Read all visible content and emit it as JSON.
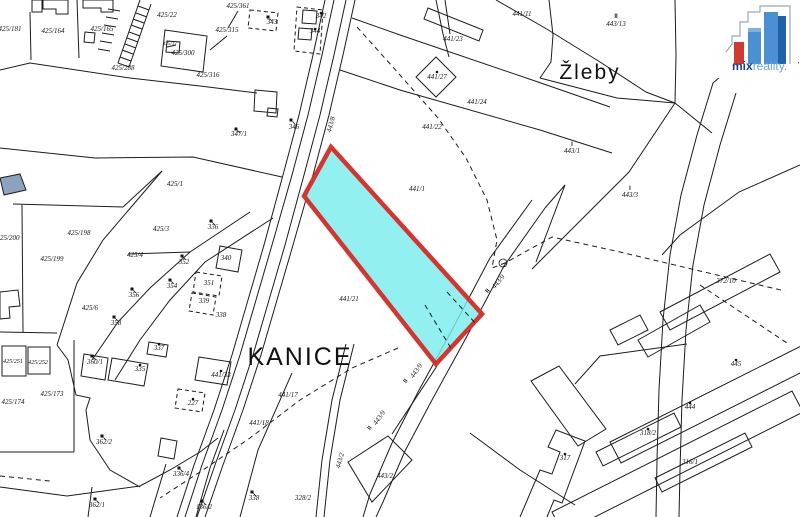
{
  "map": {
    "background": "#ffffff",
    "line_color": "#1c1c1c",
    "highlight": {
      "parcel_points": "331,147 304,196 436,364 482,314",
      "fill": "#7BEDEE",
      "fill_opacity": 0.82,
      "stroke": "#d4362f",
      "stroke_width": 4.5
    },
    "place_labels": [
      {
        "t": "KANICE",
        "x": 300,
        "y": 365,
        "s": 25
      },
      {
        "t": "Žleby",
        "x": 590,
        "y": 79,
        "s": 21
      }
    ],
    "parcel_labels": [
      {
        "t": "425/181",
        "x": 10,
        "y": 31
      },
      {
        "t": "425/164",
        "x": 53,
        "y": 33
      },
      {
        "t": "425/165",
        "x": 102,
        "y": 31
      },
      {
        "t": "425/22",
        "x": 167,
        "y": 17
      },
      {
        "t": "425/315",
        "x": 227,
        "y": 32
      },
      {
        "t": "425/361",
        "x": 238,
        "y": 8
      },
      {
        "t": "425/300",
        "x": 183,
        "y": 55
      },
      {
        "t": "425/17",
        "x": 170,
        "y": 45,
        "s": 5
      },
      {
        "t": "425/316",
        "x": 208,
        "y": 77
      },
      {
        "t": "425/288",
        "x": 123,
        "y": 70
      },
      {
        "t": "347/1",
        "x": 239,
        "y": 136
      },
      {
        "t": "343",
        "x": 272,
        "y": 24
      },
      {
        "t": "342",
        "x": 321,
        "y": 18
      },
      {
        "t": "344",
        "x": 315,
        "y": 33
      },
      {
        "t": "346",
        "x": 294,
        "y": 129
      },
      {
        "t": "441/23",
        "x": 453,
        "y": 41
      },
      {
        "t": "441/27",
        "x": 437,
        "y": 79
      },
      {
        "t": "441/24",
        "x": 477,
        "y": 104
      },
      {
        "t": "441/22",
        "x": 432,
        "y": 129
      },
      {
        "t": "441/11",
        "x": 522,
        "y": 16
      },
      {
        "t": "443/13",
        "x": 616,
        "y": 26
      },
      {
        "t": "443/1",
        "x": 572,
        "y": 153
      },
      {
        "t": "443/3",
        "x": 630,
        "y": 197
      },
      {
        "t": "441/1",
        "x": 417,
        "y": 191
      },
      {
        "t": "441/21",
        "x": 349,
        "y": 301
      },
      {
        "t": "372/10",
        "x": 726,
        "y": 283
      },
      {
        "t": "425/200",
        "x": 8,
        "y": 240
      },
      {
        "t": "425/198",
        "x": 79,
        "y": 235
      },
      {
        "t": "425/199",
        "x": 52,
        "y": 261
      },
      {
        "t": "425/1",
        "x": 175,
        "y": 186
      },
      {
        "t": "425/3",
        "x": 161,
        "y": 231
      },
      {
        "t": "425/4",
        "x": 135,
        "y": 257
      },
      {
        "t": "425/6",
        "x": 90,
        "y": 310
      },
      {
        "t": "336",
        "x": 213,
        "y": 229
      },
      {
        "t": "352",
        "x": 184,
        "y": 264
      },
      {
        "t": "354",
        "x": 172,
        "y": 288
      },
      {
        "t": "356",
        "x": 134,
        "y": 297
      },
      {
        "t": "358",
        "x": 116,
        "y": 325
      },
      {
        "t": "340",
        "x": 226,
        "y": 260
      },
      {
        "t": "351",
        "x": 209,
        "y": 285
      },
      {
        "t": "339",
        "x": 204,
        "y": 303
      },
      {
        "t": "338",
        "x": 221,
        "y": 317
      },
      {
        "t": "441/17",
        "x": 288,
        "y": 397
      },
      {
        "t": "441/18",
        "x": 259,
        "y": 425
      },
      {
        "t": "425/251",
        "x": 13,
        "y": 363,
        "s": 6
      },
      {
        "t": "425/252",
        "x": 38,
        "y": 364,
        "s": 6
      },
      {
        "t": "425/174",
        "x": 13,
        "y": 404
      },
      {
        "t": "425/173",
        "x": 52,
        "y": 396
      },
      {
        "t": "360/1",
        "x": 95,
        "y": 364
      },
      {
        "t": "335",
        "x": 140,
        "y": 371
      },
      {
        "t": "337",
        "x": 159,
        "y": 350
      },
      {
        "t": "441/33",
        "x": 221,
        "y": 377
      },
      {
        "t": "227",
        "x": 193,
        "y": 405
      },
      {
        "t": "362/2",
        "x": 104,
        "y": 444
      },
      {
        "t": "362/1",
        "x": 97,
        "y": 507
      },
      {
        "t": "336/4",
        "x": 181,
        "y": 476
      },
      {
        "t": "338",
        "x": 254,
        "y": 500
      },
      {
        "t": "136/2",
        "x": 204,
        "y": 509
      },
      {
        "t": "328/2",
        "x": 303,
        "y": 500
      },
      {
        "t": "443/2",
        "x": 385,
        "y": 478
      },
      {
        "t": "445",
        "x": 736,
        "y": 366
      },
      {
        "t": "444",
        "x": 690,
        "y": 409
      },
      {
        "t": "318/2",
        "x": 648,
        "y": 435
      },
      {
        "t": "316/1",
        "x": 690,
        "y": 464
      },
      {
        "t": "317",
        "x": 565,
        "y": 460
      }
    ],
    "road_labels": [
      {
        "t": "443/9",
        "x": 418,
        "y": 372,
        "r": -55
      },
      {
        "t": "443/9",
        "x": 381,
        "y": 419,
        "r": -55
      },
      {
        "t": "443/9",
        "x": 500,
        "y": 283,
        "r": -50
      },
      {
        "t": "443/8",
        "x": 333,
        "y": 125,
        "r": -75
      },
      {
        "t": "443/2",
        "x": 342,
        "y": 461,
        "r": -75
      }
    ],
    "symbols": [
      {
        "g": "dot",
        "x": 321,
        "y": 13
      },
      {
        "g": "dot",
        "x": 315,
        "y": 29
      },
      {
        "g": "dot",
        "x": 437,
        "y": 72
      },
      {
        "g": "dot",
        "x": 221,
        "y": 371
      },
      {
        "g": "dot",
        "x": 193,
        "y": 399
      },
      {
        "g": "dot",
        "x": 140,
        "y": 365
      },
      {
        "g": "dot",
        "x": 159,
        "y": 344
      },
      {
        "g": "dot",
        "x": 736,
        "y": 360
      },
      {
        "g": "dot",
        "x": 690,
        "y": 403
      },
      {
        "g": "dot",
        "x": 648,
        "y": 429
      },
      {
        "g": "dot",
        "x": 565,
        "y": 454
      },
      {
        "g": "flag",
        "x": 268,
        "y": 17
      },
      {
        "g": "flag",
        "x": 291,
        "y": 120
      },
      {
        "g": "flag",
        "x": 236,
        "y": 129
      },
      {
        "g": "flag",
        "x": 211,
        "y": 221
      },
      {
        "g": "flag",
        "x": 182,
        "y": 256
      },
      {
        "g": "flag",
        "x": 170,
        "y": 280
      },
      {
        "g": "flag",
        "x": 132,
        "y": 289
      },
      {
        "g": "flag",
        "x": 114,
        "y": 317
      },
      {
        "g": "flag",
        "x": 92,
        "y": 356
      },
      {
        "g": "flag",
        "x": 102,
        "y": 436
      },
      {
        "g": "flag",
        "x": 95,
        "y": 499
      },
      {
        "g": "flag",
        "x": 179,
        "y": 468
      },
      {
        "g": "flag",
        "x": 252,
        "y": 492
      },
      {
        "g": "flag",
        "x": 202,
        "y": 501
      },
      {
        "g": "I",
        "x": 572,
        "y": 146
      },
      {
        "g": "I",
        "x": 630,
        "y": 190
      },
      {
        "g": "II",
        "x": 616,
        "y": 18
      },
      {
        "g": "II",
        "x": 407,
        "y": 382,
        "r": -55
      },
      {
        "g": "II",
        "x": 371,
        "y": 429,
        "r": -55
      },
      {
        "g": "II",
        "x": 489,
        "y": 292,
        "r": -50
      },
      {
        "g": "circ",
        "x": 503,
        "y": 263
      }
    ],
    "lines": [
      {
        "p": "30,12 31,60"
      },
      {
        "p": "77,0 79,58"
      },
      {
        "p": "0,70 30,63 130,78 200,86 257,93"
      },
      {
        "p": "0,148 95,158 193,157 282,177"
      },
      {
        "p": "0,332 57,333"
      },
      {
        "p": "22,205 23,332"
      },
      {
        "p": "13,204 123,207"
      },
      {
        "p": "123,207 162,171"
      },
      {
        "p": "162,171 103,240 77,283 57,345"
      },
      {
        "p": "57,345 68,360 76,395 90,398 86,410 90,440 110,470 140,487"
      },
      {
        "p": "0,487 67,496 140,486 170,470 200,452 218,438"
      },
      {
        "p": "250,212 190,252 150,288 118,322 92,360"
      },
      {
        "p": "273,218 205,262 170,300 140,340 115,380"
      },
      {
        "p": "128,254 190,252"
      },
      {
        "p": "140,0 118,63"
      },
      {
        "p": "151,4 129,67"
      },
      {
        "p": "138,6 149,10"
      },
      {
        "p": "136,13 147,17"
      },
      {
        "p": "133,19 144,23"
      },
      {
        "p": "131,25 142,29"
      },
      {
        "p": "129,32 140,36"
      },
      {
        "p": "127,38 138,42"
      },
      {
        "p": "125,44 136,48"
      },
      {
        "p": "122,50 133,54"
      },
      {
        "p": "120,57 131,61"
      },
      {
        "p": "118,63 129,67"
      },
      {
        "p": "108,9 120,11"
      },
      {
        "p": "106,17 118,19"
      },
      {
        "p": "104,25 116,27"
      },
      {
        "p": "102,33 114,35"
      },
      {
        "p": "100,41 112,43"
      },
      {
        "p": "98,49 110,51"
      },
      {
        "p": "227,36 210,50"
      },
      {
        "p": "238,11 228,28"
      },
      {
        "p": "176,45 167,47"
      },
      {
        "p": "325,0 313,55 299,115 283,175 264,245 248,300 232,355 214,410 194,465 177,517"
      },
      {
        "p": "334,0 322,55 308,115 292,175 272,245 256,300 240,355 222,410 202,465 185,517"
      },
      {
        "p": "346,0 334,55 320,115 304,175 285,245 269,300 253,355 235,410 215,465 197,517"
      },
      {
        "p": "355,0 343,55 329,115 313,175 293,245 277,300 261,355 243,410 223,465 205,517"
      },
      {
        "p": "532,200 490,258 452,330 418,392 392,443 370,494 363,517"
      },
      {
        "p": "545,208 504,266 466,338 432,400 405,451 383,502 376,517"
      },
      {
        "p": "745,55 713,83 697,135 681,195 670,255 663,320 659,390 657,460 656,517"
      },
      {
        "p": "736,93 720,145 704,205 693,265 686,330 682,400 680,470 679,517"
      },
      {
        "p": "436,0 443,34 449,57"
      },
      {
        "p": "445,0 450,34"
      },
      {
        "p": "496,0 545,28 600,62 646,92 675,103"
      },
      {
        "p": "549,0 553,35 551,62 540,78"
      },
      {
        "p": "540,78 617,98 675,103"
      },
      {
        "p": "675,0 676,55 675,103"
      },
      {
        "p": "675,103 712,133"
      },
      {
        "p": "675,103 629,172 532,269"
      },
      {
        "p": "800,165 739,192 680,235 662,255"
      },
      {
        "p": "762,50 799,63"
      },
      {
        "p": "352,18 400,35 538,82 610,107"
      },
      {
        "p": "340,70 400,90 540,130 612,153"
      },
      {
        "p": "536,262 565,185 545,208"
      },
      {
        "p": "346,344 332,400 322,460 316,517"
      },
      {
        "p": "354,344 340,400 330,460 324,517"
      },
      {
        "p": "292,373 258,450 240,517"
      },
      {
        "p": "392,434 437,366"
      },
      {
        "p": "470,433 520,470 575,505"
      },
      {
        "p": "687,344 600,356 575,384"
      },
      {
        "p": "74,340 74,452"
      },
      {
        "p": "0,452 74,452"
      },
      {
        "p": "92,487 88,517"
      },
      {
        "p": "150,517 166,464"
      },
      {
        "p": "196,517 210,468 224,430"
      },
      {
        "p": "520,517 540,470 552,474 560,452 548,447 556,430 585,441 562,503 554,500 547,517"
      },
      {
        "p": "357,27 400,75 438,118 466,158 487,200 497,240 492,268 505,263 552,237 620,252 700,271 785,291",
        "d": 1
      },
      {
        "p": "398,348 352,368 300,400 250,438 200,472 160,498",
        "d": 1
      },
      {
        "p": "700,285 745,315 790,345",
        "d": 1
      },
      {
        "p": "0,476 50,481",
        "d": 1
      }
    ],
    "polygons": [
      {
        "p": "32,0 42,0 42,12 32,12"
      },
      {
        "p": "43,0 68,0 68,14 56,14 56,9 43,9"
      },
      {
        "p": "83,0 113,0 113,12 101,12 101,8 83,8"
      },
      {
        "p": "85,32 95,33 94,43 84,42"
      },
      {
        "p": "165,30 207,36 203,72 161,66"
      },
      {
        "p": "167,41 180,42 179,53 166,52"
      },
      {
        "p": "255,90 277,92 276,113 254,111"
      },
      {
        "p": "268,108 278,109 277,117 267,116"
      },
      {
        "p": "250,10 278,13 276,31 248,28",
        "d": 1
      },
      {
        "p": "297,7 323,10 320,54 294,51",
        "d": 1
      },
      {
        "p": "303,10 317,11 316,24 302,23"
      },
      {
        "p": "299,28 312,29 311,40 298,39"
      },
      {
        "p": "436,57 456,77 436,97 416,77"
      },
      {
        "p": "428,8 483,30 479,41 424,19"
      },
      {
        "p": "0,178 20,174 26,190 4,195",
        "f": "#8BA3BF"
      },
      {
        "p": "2,346 26,346 26,376 2,376"
      },
      {
        "p": "28,347 50,347 50,374 28,374"
      },
      {
        "p": "84,354 108,358 105,380 81,376"
      },
      {
        "p": "112,358 148,364 144,386 108,380"
      },
      {
        "p": "149,342 168,345 166,357 147,354"
      },
      {
        "p": "199,357 231,362 227,385 195,380"
      },
      {
        "p": "178,389 205,393 202,412 175,408",
        "d": 1
      },
      {
        "p": "161,438 177,441 174,459 158,456"
      },
      {
        "p": "220,246 242,250 238,272 216,268"
      },
      {
        "p": "196,272 222,276 219,296 193,292",
        "d": 1
      },
      {
        "p": "192,293 216,297 213,315 189,311",
        "d": 1
      },
      {
        "p": "0,292 18,290 20,306 9,307 10,318 0,319"
      },
      {
        "p": "348,462 388,436 412,460 372,502"
      },
      {
        "p": "610,442 815,339 826,360 621,463"
      },
      {
        "p": "552,512 792,391 803,412 563,533"
      },
      {
        "p": "596,452 674,413 681,427 603,466"
      },
      {
        "p": "655,478 745,433 752,447 662,492"
      },
      {
        "p": "660,312 770,254 780,272 670,330"
      },
      {
        "p": "638,340 700,305 710,322 648,357"
      },
      {
        "p": "610,330 640,315 648,330 618,345"
      },
      {
        "p": "531,381 559,366 606,429 578,446"
      }
    ],
    "overlay_dashes": [
      {
        "p": "425,305 452,350"
      },
      {
        "p": "447,292 477,325"
      }
    ]
  },
  "logo": {
    "mix": "mix",
    "reality": "reality.",
    "red": "#cf3a31",
    "blue_light": "#4a90d2",
    "blue_dark": "#2062a8"
  }
}
